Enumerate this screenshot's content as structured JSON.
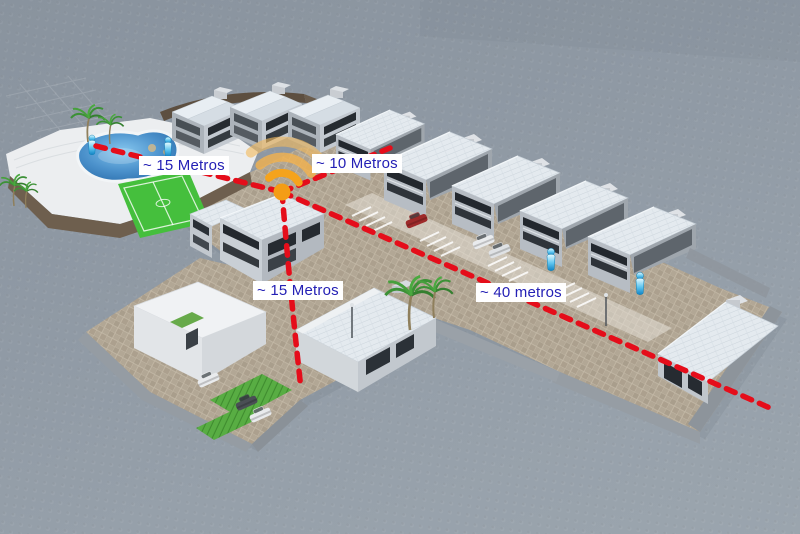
{
  "annotations": {
    "wifi_hotspot_icon": "wifi-signal-icon",
    "distances": [
      {
        "id": "to-pool-area",
        "text": "~ 15 Metros"
      },
      {
        "id": "to-right-houses",
        "text": "~ 10 Metros"
      },
      {
        "id": "to-lower-houses",
        "text": "~ 15 Metros"
      },
      {
        "id": "to-far-houses",
        "text": "~ 40 metros"
      }
    ],
    "label_text_color": "#2420B5",
    "label_bg_color": "#FFFFFF",
    "coverage_line_color": "#E50D1A",
    "wifi_color": "#F5A31C"
  },
  "scene": {
    "elements": [
      "swimming-pool",
      "soccer-field",
      "amenity-deck",
      "row-houses-top",
      "row-houses-right",
      "corner-house",
      "duplex-house",
      "clubhouse-warehouse",
      "apartment-building",
      "parking-stripes",
      "cars",
      "palm-trees",
      "person-markers",
      "perimeter-walls",
      "street-lamps"
    ],
    "colors": {
      "background": "#8F99A4",
      "pavement": "#B3A897",
      "roof": "#E4EAEF",
      "deck_fascia": "#6E5F4E",
      "pool_water": "#3E7FBE",
      "field_green": "#45BF3D",
      "lawn_green": "#58AD43",
      "person_marker": "#17A5E5"
    }
  }
}
